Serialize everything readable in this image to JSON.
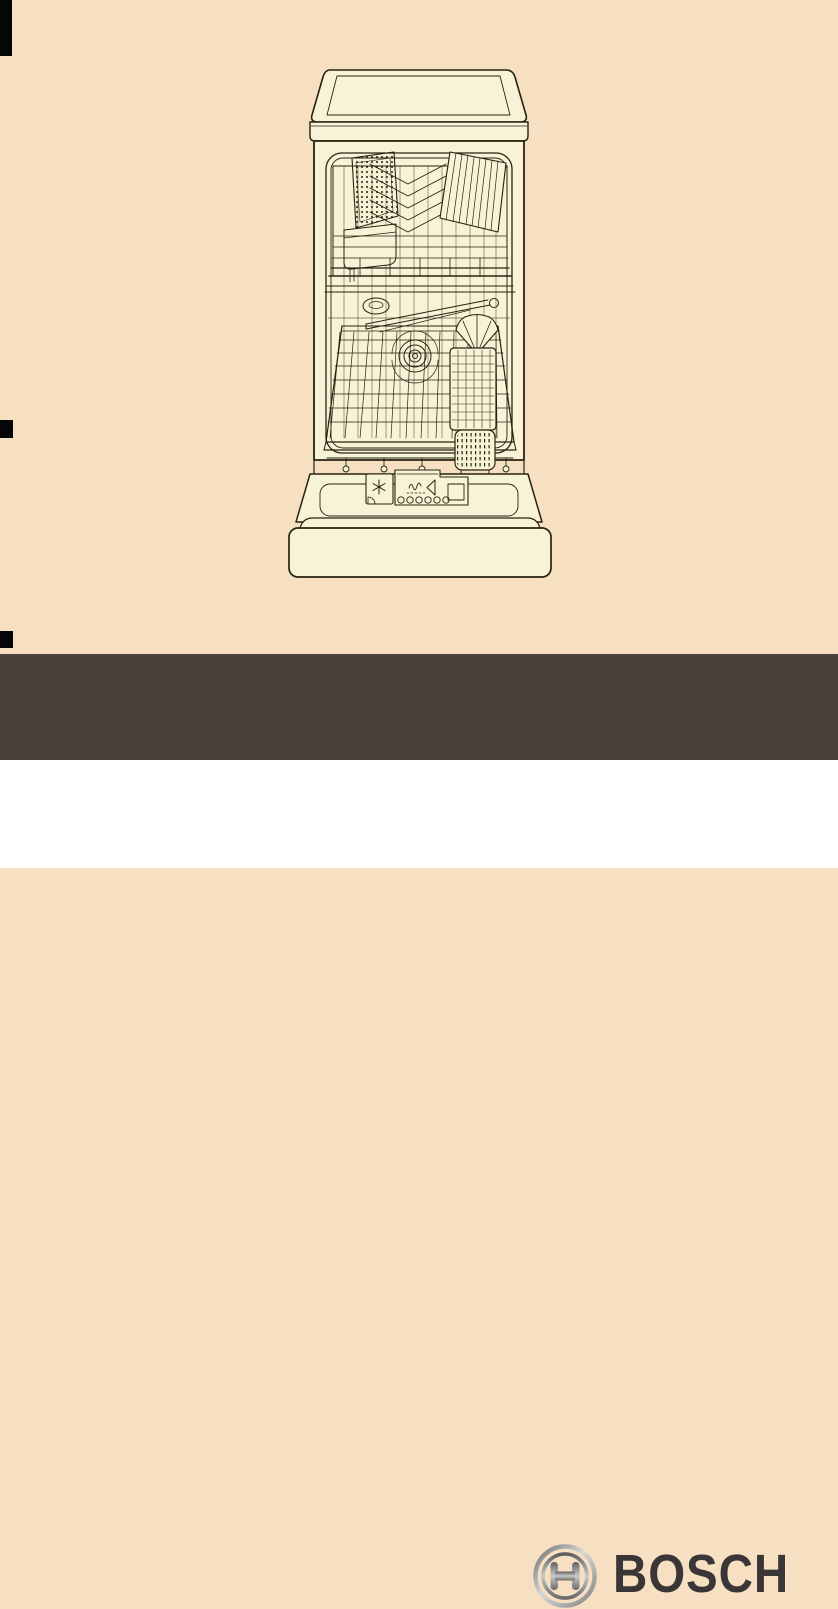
{
  "page": {
    "kind": "appliance manual cover",
    "background_color": "#f7e0c2",
    "accent_band_color": "#48423a",
    "logo_band_color": "#ffffff"
  },
  "brand": {
    "name": "BOSCH",
    "wordmark_color": "#3a3637",
    "emblem": "bosch-armature-in-circle"
  },
  "illustration": {
    "name": "dishwasher-line-drawing",
    "subject": "Open freestanding dishwasher showing upper basket, lower basket, cutlery basket and detergent dispenser on the open door",
    "line_color": "#262210",
    "fill_color": "#f8f3d6"
  },
  "print_marks": {
    "count": 3,
    "color": "#060606"
  }
}
